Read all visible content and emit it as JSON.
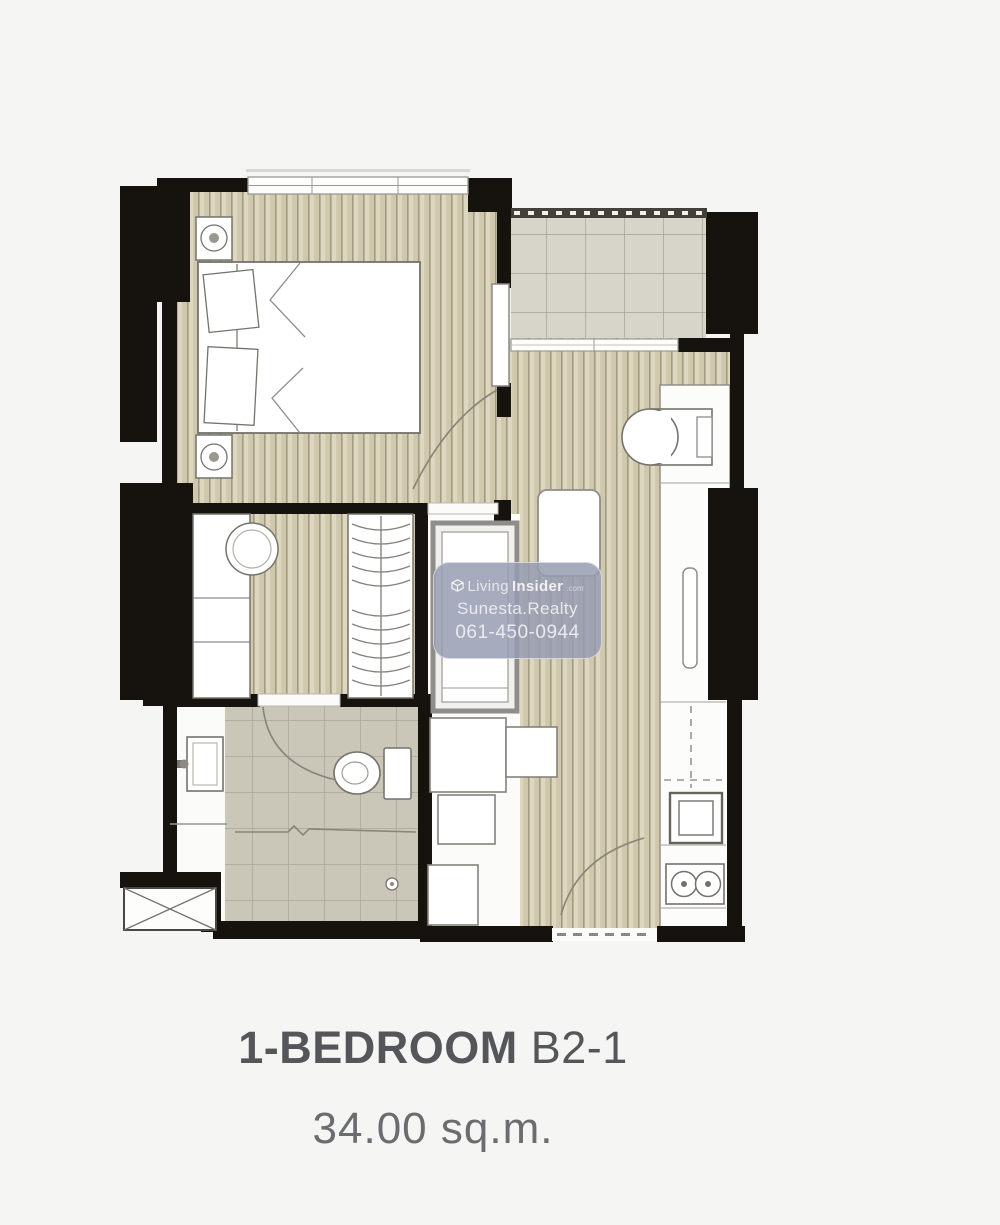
{
  "watermark": {
    "brand_light": "Living",
    "brand_bold": "Insider",
    "brand_suffix": ".com",
    "agent": "Sunesta.Realty",
    "phone": "061-450-0944"
  },
  "caption": {
    "type_bold": "1-BEDROOM",
    "unit": "B2-1",
    "area": "34.00 sq.m."
  },
  "colors": {
    "background": "#f5f5f4",
    "wall": "#16130f",
    "wood_floor": "#d8d1b6",
    "wood_line": "#a29a81",
    "balcony_tile": "#d7d4ca",
    "bath_tile": "#cac6b8",
    "fixture_outline": "#75726c",
    "watermark_bg": "rgba(151,156,177,0.85)",
    "title_text": "#55565a",
    "area_text": "#6b6c6f"
  }
}
